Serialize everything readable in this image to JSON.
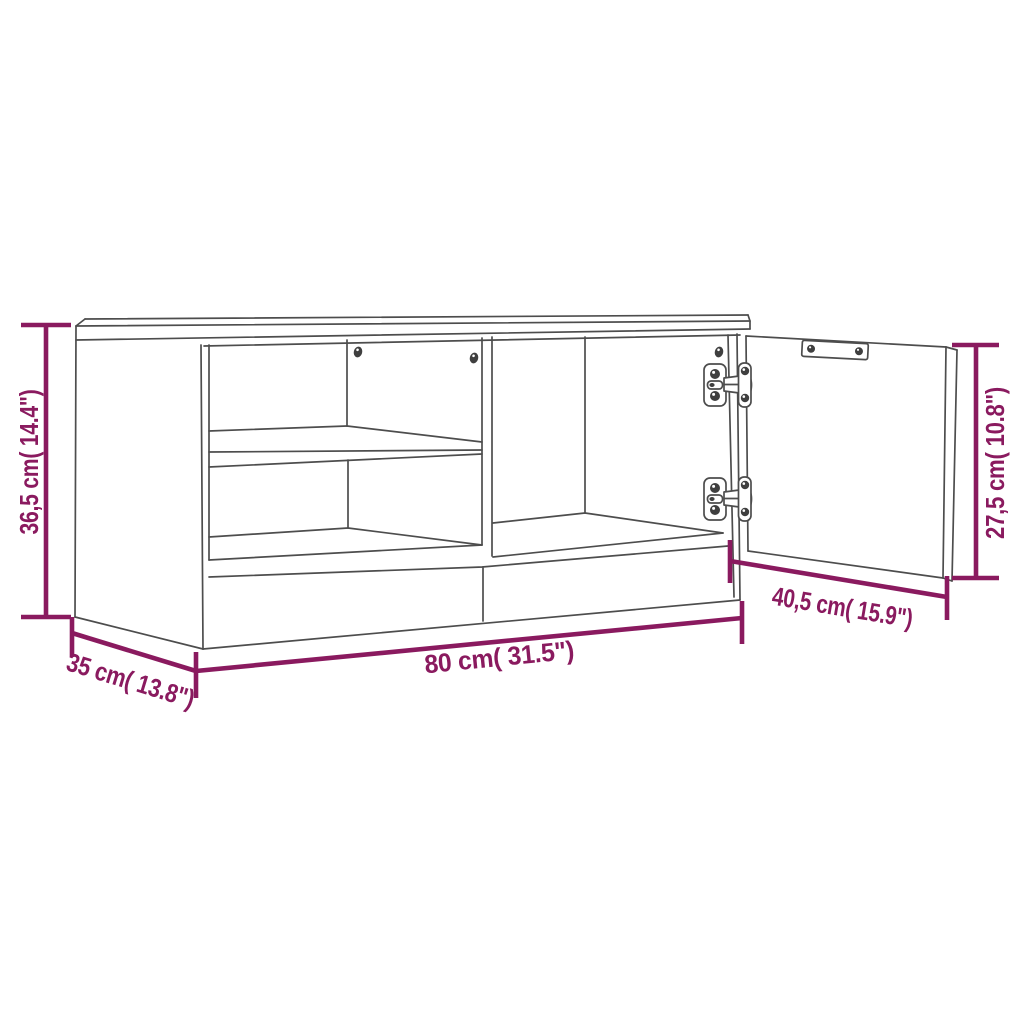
{
  "diagram": {
    "type": "furniture-dimension-diagram",
    "dimensions": {
      "height_label": "36,5 cm( 14.4\")",
      "width_label": "80 cm( 31.5\")",
      "depth_label": "35 cm( 13.8\")",
      "door_width_label": "40,5 cm( 15.9\")",
      "door_height_label": "27,5 cm( 10.8\")"
    },
    "colors": {
      "dimension_accent": "#8a1a5f",
      "line_art": "#4d4d4d",
      "background": "#ffffff"
    }
  }
}
